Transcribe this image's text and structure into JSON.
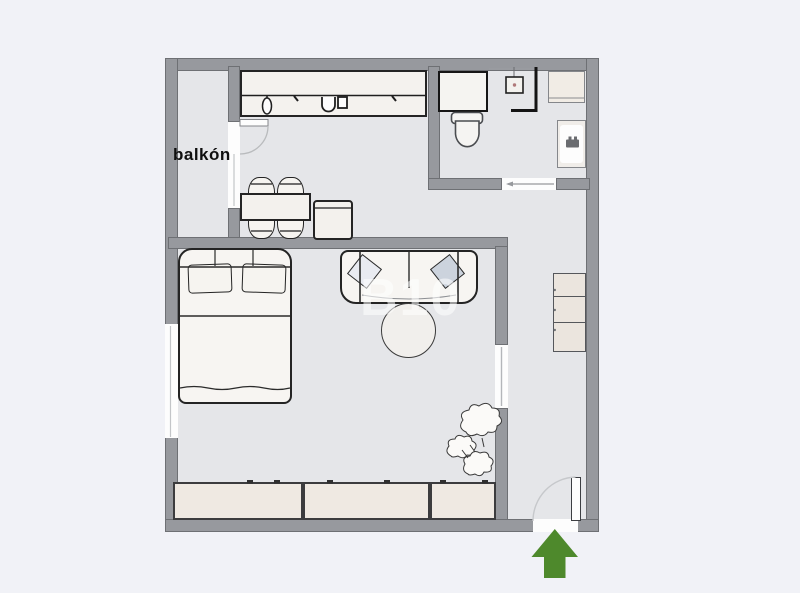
{
  "floorplan": {
    "balcony_label": "balkón",
    "watermark": "B10",
    "entrance": {
      "arrow_color": "#4e892c",
      "direction": "up"
    },
    "colors": {
      "page_background": "#f1f2f7",
      "floor": "#e5e6e9",
      "wall_fill": "#97999e",
      "wall_edge": "#6e7074",
      "furniture_fill": "#f6f4f0",
      "furniture_outline": "#242424",
      "beige_fill": "#efe9e2",
      "pillow_accent": "#ccd3dd",
      "window_fill": "#fdfdfd"
    },
    "items": [
      "kitchen-counter",
      "kitchen-sink",
      "kitchen-faucet",
      "dining-table",
      "dining-chair",
      "side-cabinet",
      "balcony",
      "balcony-door",
      "balcony-window",
      "washing-machine",
      "shower",
      "toilet",
      "washbasin",
      "bathroom-cabinet",
      "bathroom-sliding-door",
      "double-bed",
      "bed-pillow",
      "sofa",
      "sofa-cushion",
      "coffee-table",
      "wardrobe",
      "shelf-unit",
      "plant",
      "hall-sliding-door",
      "entrance-door",
      "entrance-arrow",
      "window"
    ]
  }
}
